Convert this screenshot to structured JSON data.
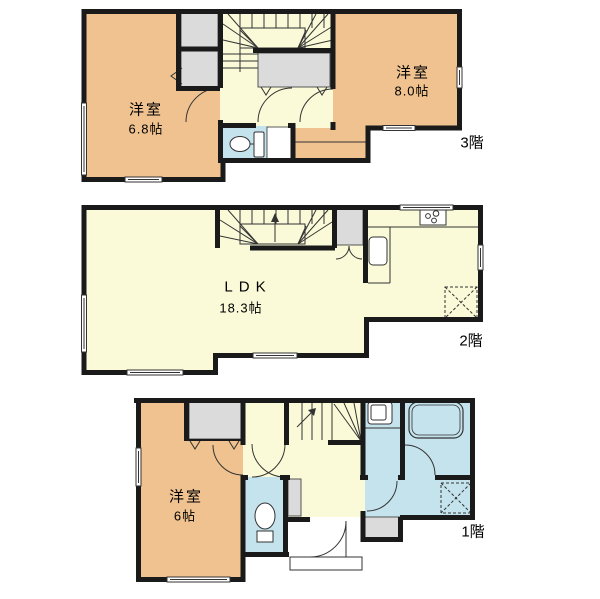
{
  "plan": {
    "type": "residential-floorplan",
    "floors": [
      {
        "floor_label": "3階",
        "rooms": [
          {
            "name": "洋室",
            "size": "6.8帖"
          },
          {
            "name": "洋室",
            "size": "8.0帖"
          }
        ]
      },
      {
        "floor_label": "2階",
        "rooms": [
          {
            "name": "LDK",
            "size": "18.3帖"
          }
        ]
      },
      {
        "floor_label": "1階",
        "rooms": [
          {
            "name": "洋室",
            "size": "6帖"
          }
        ]
      }
    ],
    "colors": {
      "wall": "#1a1a1a",
      "western_room": "#efc28f",
      "living_area": "#fafad8",
      "sanitary": "#c4e3ed",
      "closet": "#dbdbdb",
      "background": "#ffffff"
    },
    "icons": [
      "staircase",
      "toilet-icon",
      "bathtub-icon",
      "washbasin-icon",
      "kitchen-sink-icon",
      "stove-icon",
      "refrigerator-space-icon",
      "washing-machine-space-icon",
      "closet",
      "window",
      "door-arc"
    ]
  }
}
